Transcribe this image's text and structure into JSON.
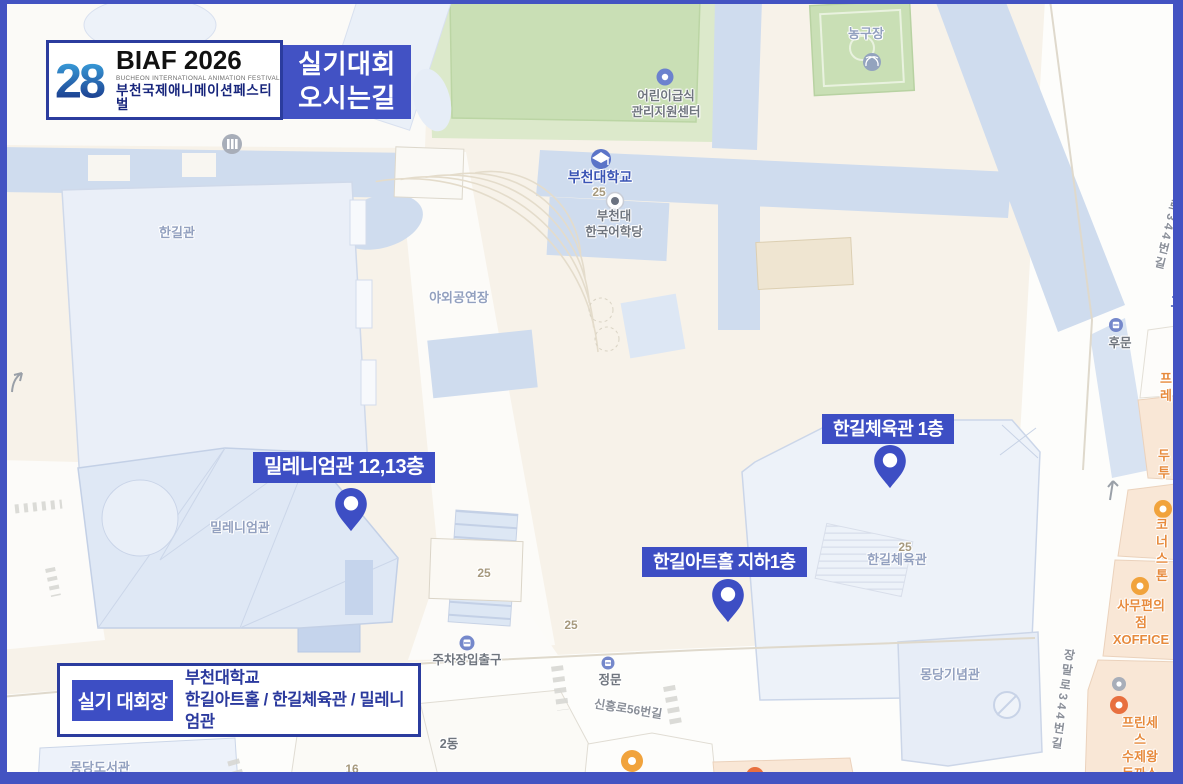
{
  "header": {
    "logo": {
      "number": "28",
      "title": "BIAF 2026",
      "subtitle_en": "BUCHEON INTERNATIONAL ANIMATION FESTIVAL",
      "subtitle_ko": "부천국제애니메이션페스티벌"
    },
    "page_title": "실기대회\n오시는길"
  },
  "venue_banner": {
    "badge": "실기 대회장",
    "university": "부천대학교",
    "halls": "한길아트홀 / 한길체육관 / 밀레니엄관"
  },
  "pins": [
    {
      "label": "밀레니엄관 12,13층"
    },
    {
      "label": "한길체육관 1층"
    },
    {
      "label": "한길아트홀 지하1층"
    }
  ],
  "map": {
    "labels": [
      {
        "text": "농구장"
      },
      {
        "text": "어린이급식\n관리지원센터"
      },
      {
        "text": "부천대학교"
      },
      {
        "text": "25"
      },
      {
        "text": "부천대\n한국어학당"
      },
      {
        "text": "한길관"
      },
      {
        "text": "야외공연장"
      },
      {
        "text": "밀레니엄관"
      },
      {
        "text": "25"
      },
      {
        "text": "한길체육관"
      },
      {
        "text": "몽당기념관"
      },
      {
        "text": "몽당도서관"
      },
      {
        "text": "16"
      },
      {
        "text": "2동"
      },
      {
        "text": "주차장입출구"
      },
      {
        "text": "정문"
      },
      {
        "text": "신흥로56번길"
      },
      {
        "text": "후문"
      },
      {
        "text": "로344번길"
      },
      {
        "text": "고"
      },
      {
        "text": "프레"
      },
      {
        "text": "두투"
      },
      {
        "text": "코너스톤"
      },
      {
        "text": "사무편의점\nXOFFICE"
      },
      {
        "text": "프린세스\n수제왕돈까스"
      },
      {
        "text": "이마트24"
      },
      {
        "text": "장말로344번길"
      },
      {
        "text": "25"
      },
      {
        "text": "25"
      }
    ]
  },
  "colors": {
    "accent_blue": "#3D4EC4",
    "frame_blue": "#4353C2",
    "navy_text": "#2B3A9E",
    "building_blue": "#CFDCEE",
    "field_green": "#C9DFB5",
    "poi_orange": "#E78A3C"
  }
}
